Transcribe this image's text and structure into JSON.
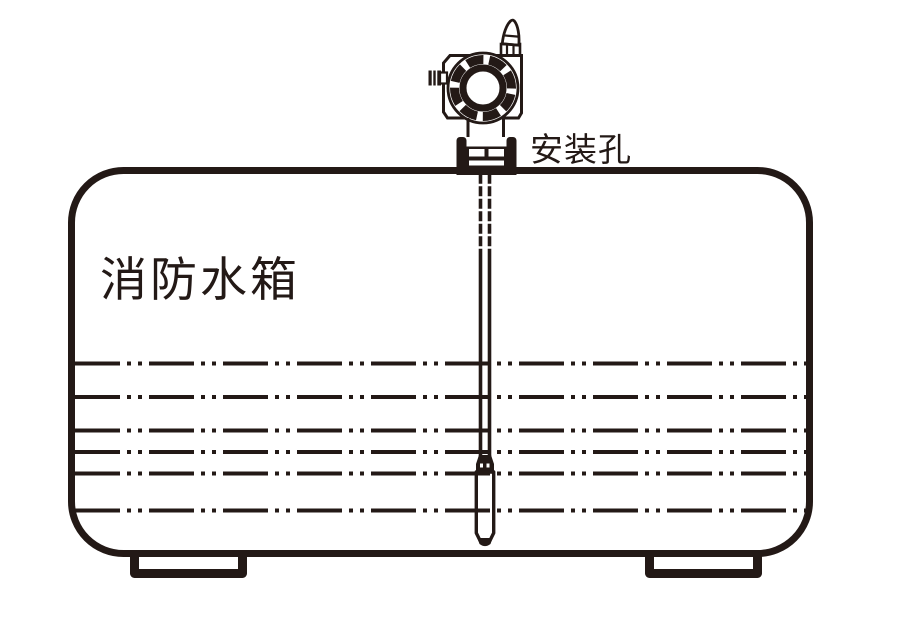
{
  "diagram": {
    "tank_label": "消防水箱",
    "mounting_hole_label": "安装孔",
    "colors": {
      "ink": "#231916",
      "background": "#ffffff"
    },
    "device_parts": [
      "wireless-antenna-icon",
      "transmitter-head-icon",
      "cable-gland-icon",
      "mounting-fitting-icon",
      "sensor-cable",
      "submersible-probe-icon"
    ],
    "water_level_lines": {
      "count": 6,
      "style": "dash-dot",
      "y_positions": [
        363.5,
        397,
        430.5,
        452,
        473.5,
        510.5
      ]
    }
  }
}
